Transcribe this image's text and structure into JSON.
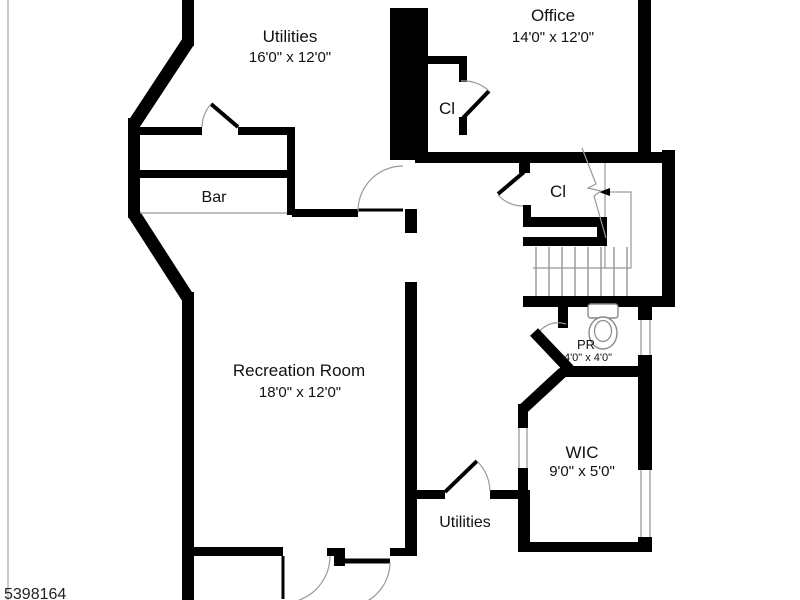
{
  "plan": {
    "watermark": "5398164",
    "rooms": {
      "utilities_top": {
        "name": "Utilities",
        "dims": "16'0\" x 12'0\""
      },
      "office": {
        "name": "Office",
        "dims": "14'0\" x 12'0\""
      },
      "closet_top": {
        "name": "Cl"
      },
      "closet_mid": {
        "name": "Cl"
      },
      "bar": {
        "name": "Bar"
      },
      "recreation_room": {
        "name": "Recreation Room",
        "dims": "18'0\" x 12'0\""
      },
      "powder_room": {
        "name": "PR",
        "dims": "4'0\" x 4'0\""
      },
      "wic": {
        "name": "WIC",
        "dims": "9'0\" x 5'0\""
      },
      "utilities_bottom": {
        "name": "Utilities"
      }
    },
    "colors": {
      "wall": "#000000",
      "background": "#ffffff",
      "thin": "#999999"
    }
  }
}
